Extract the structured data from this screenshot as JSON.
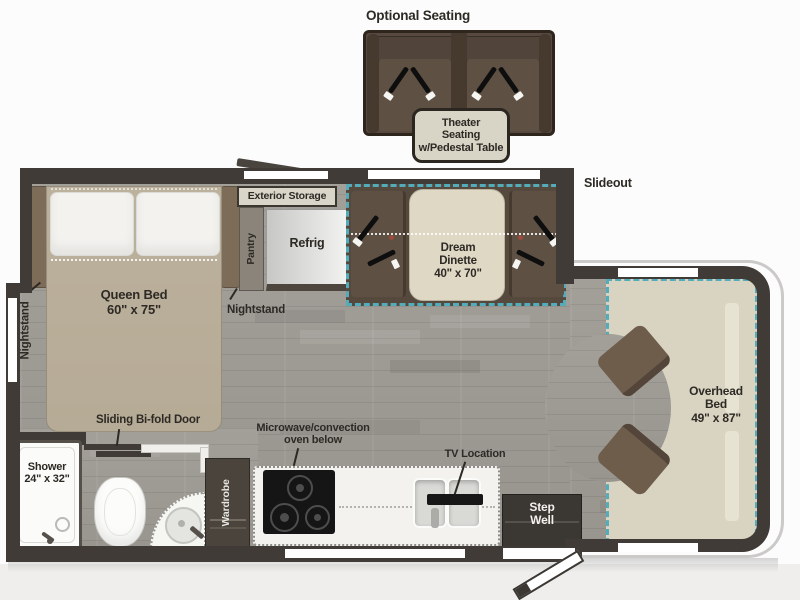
{
  "colors": {
    "accent": "#54acba",
    "wall": "#403b36",
    "ink": "#2d2924",
    "floor": "#98948e",
    "bed": "#b6ab96",
    "table": "#ded8c5",
    "seat": "#5e5144",
    "cabseat": "#6f5d4c",
    "overhead": "#d9d4c2",
    "labelbox": "#d8d4c6",
    "theater": "#574940",
    "theaterdark": "#463a2f"
  },
  "optional_seating": {
    "heading": "Optional Seating",
    "tag_lines": [
      "Theater",
      "Seating",
      "w/Pedestal Table"
    ]
  },
  "plan": {
    "slideout_label": "Slideout",
    "bedroom": {
      "queen_bed_lines": [
        "Queen Bed",
        "60\" x 75\""
      ],
      "nightstand_left": "Nightstand",
      "nightstand_right": "Nightstand",
      "bifold_door": "Sliding Bi-fold Door"
    },
    "storage": {
      "exterior_storage": "Exterior Storage",
      "pantry": "Pantry",
      "refrig": "Refrig",
      "wardrobe": "Wardrobe"
    },
    "dinette": {
      "lines": [
        "Dream",
        "Dinette",
        "40\" x 70\""
      ]
    },
    "kitchen": {
      "microwave_lines": [
        "Microwave/convection",
        "oven below"
      ],
      "tv_location": "TV Location"
    },
    "bath": {
      "shower_lines": [
        "Shower",
        "24\" x 32\""
      ]
    },
    "cab": {
      "overhead_bed_lines": [
        "Overhead",
        "Bed",
        "49\" x 87\""
      ],
      "step_well_lines": [
        "Step",
        "Well"
      ]
    }
  }
}
